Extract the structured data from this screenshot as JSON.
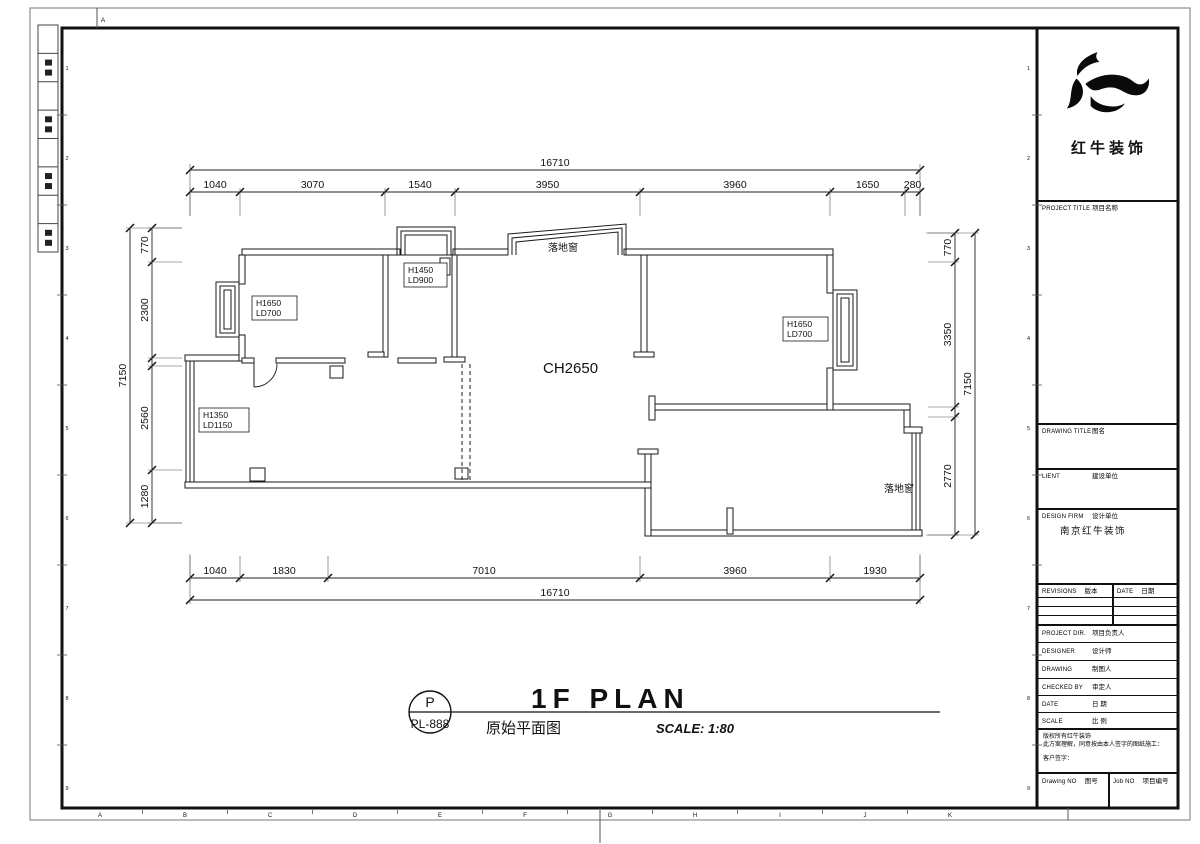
{
  "sheet": {
    "top_left_grid_letter": "A",
    "bottom_grid_letters": [
      "A",
      "B",
      "C",
      "D",
      "E",
      "F",
      "G",
      "H",
      "I",
      "J",
      "K"
    ],
    "side_grid_numbers": [
      "1",
      "2",
      "3",
      "4",
      "5",
      "6",
      "7",
      "8",
      "9"
    ]
  },
  "plan": {
    "ceiling_height_label": "CH2650",
    "top_window_label": "落地窗",
    "right_window_label": "落地窗",
    "window_tags": {
      "left_bay": {
        "line1": "H1650",
        "line2": "LD700"
      },
      "top": {
        "line1": "H1450",
        "line2": "LD900"
      },
      "right_bay": {
        "line1": "H1650",
        "line2": "LD700"
      },
      "left_lower": {
        "line1": "H1350",
        "line2": "LD1150"
      }
    }
  },
  "dimensions": {
    "top_overall": [
      "16710"
    ],
    "top_segments": [
      "1040",
      "3070",
      "1540",
      "3950",
      "3960",
      "1650",
      "280"
    ],
    "bottom_segments": [
      "1040",
      "1830",
      "7010",
      "3960",
      "1930"
    ],
    "bottom_overall": [
      "16710"
    ],
    "left_segments": [
      "770",
      "2300",
      "",
      "2560",
      "1280"
    ],
    "left_overall": [
      "7150"
    ],
    "right_segments": [
      "770",
      "3350",
      "",
      "2770"
    ],
    "right_overall": [
      "7150"
    ]
  },
  "title_bar": {
    "badge_top": "P",
    "badge_bottom": "PL-888",
    "title_en": "1F PLAN",
    "title_cn": "原始平面图",
    "scale_text": "SCALE: 1:80"
  },
  "title_block": {
    "logo_name": "红牛装饰",
    "project_title": {
      "en": "PROJECT TITLE",
      "cn": "项目名称"
    },
    "drawing_title": {
      "en": "DRAWING TITLE",
      "cn": "图名"
    },
    "client": {
      "en": "LIENT",
      "cn": "建设单位"
    },
    "design_firm": {
      "en": "DESIGN FIRM",
      "cn": "设计单位"
    },
    "design_firm_value": "南京红牛装饰",
    "revisions": {
      "en": "REVISIONS",
      "cn": "版本"
    },
    "rev_date": {
      "en": "DATE",
      "cn": "日期"
    },
    "project_dir": {
      "en": "PROJECT DIR.",
      "cn": "项目负责人"
    },
    "designer": {
      "en": "DESIGNER",
      "cn": "设计师"
    },
    "drawing": {
      "en": "DRAWING",
      "cn": "制图人"
    },
    "checked_by": {
      "en": "CHECKED BY",
      "cn": "审定人"
    },
    "date": {
      "en": "DATE",
      "cn": "日 期"
    },
    "scale": {
      "en": "SCALE",
      "cn": "比 例"
    },
    "copyright_line1": "版权所有红牛装饰",
    "copyright_line2": "此方案理解，同意按由本人签字的图纸施工：",
    "copyright_line3": "客户签字：",
    "drawing_no": {
      "en": "Drawing NO",
      "cn": "图号"
    },
    "job_no": {
      "en": "Job NO",
      "cn": "项目编号"
    }
  }
}
